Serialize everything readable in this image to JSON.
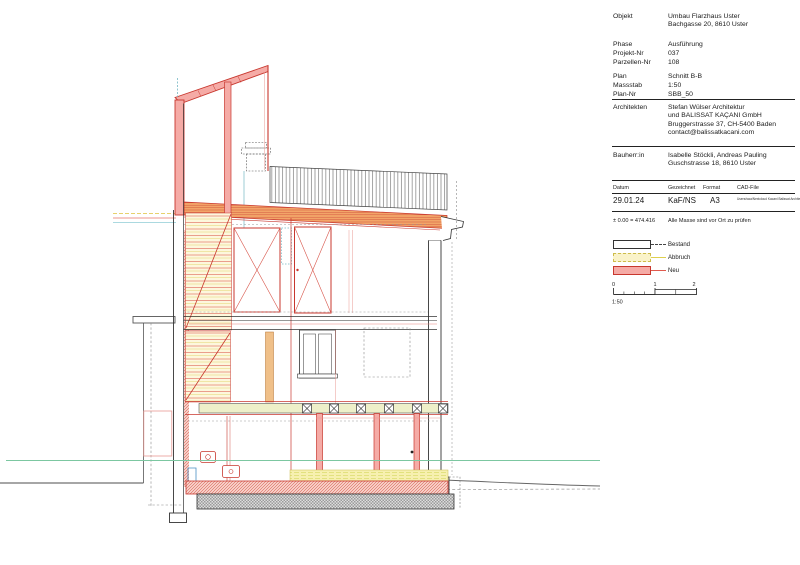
{
  "sheet": {
    "title_block": {
      "rows": [
        {
          "label": "Objekt",
          "value": "Umbau Flarzhaus Uster\nBachgasse 20, 8610 Uster"
        },
        {
          "label": "Phase",
          "value": "Ausführung"
        },
        {
          "label": "Projekt-Nr",
          "value": "037"
        },
        {
          "label": "Parzellen-Nr",
          "value": "108"
        },
        {
          "label": "Plan",
          "value": "Schnitt B-B"
        },
        {
          "label": "Massstab",
          "value": "1:50"
        },
        {
          "label": "Plan-Nr",
          "value": "SBB_50"
        },
        {
          "label": "Architekten",
          "value": "Stefan Wülser Architektur\nund BALISSAT KAÇANI GmbH\nBruggerstrasse 37, CH-5400 Baden\ncontact@balissatkacani.com"
        },
        {
          "label": "Bauherr:in",
          "value": "Isabelle Stöckli, Andreas Pauling\nGuschstrasse 18, 8610 Uster"
        }
      ],
      "meta": {
        "h0": "Datum",
        "h1": "Gezeichnet",
        "h2": "Format",
        "h3": "CAD-File",
        "datum": "29.01.24",
        "gezeichnet": "KaF/NS",
        "format": "A3",
        "cad_file": "Users/swa/Nextcloud Kacani Balissat\nArchitektur – PROJEKTE/037 FLARZHAUS\n05 PLAENE/DWG/037_Schnitt_B-B.dwg"
      },
      "notes": {
        "elevation": "± 0.00 = 474.416",
        "check": "Alle Masse sind vor Ort zu prüfen"
      }
    },
    "legend": {
      "items": [
        {
          "label": "Bestand"
        },
        {
          "label": "Abbruch"
        },
        {
          "label": "Neu"
        }
      ]
    },
    "scale_bar": {
      "t0": "0",
      "t1": "1",
      "t2": "2",
      "ratio": "1:50"
    },
    "colors": {
      "neu": "#c8372e",
      "neu_fill": "#f5aba6",
      "abbruch_line": "#d9c84e",
      "abbruch_fill": "#faf3c9",
      "bestand": "#333333",
      "terrain_green": "#7cc7a1"
    }
  }
}
